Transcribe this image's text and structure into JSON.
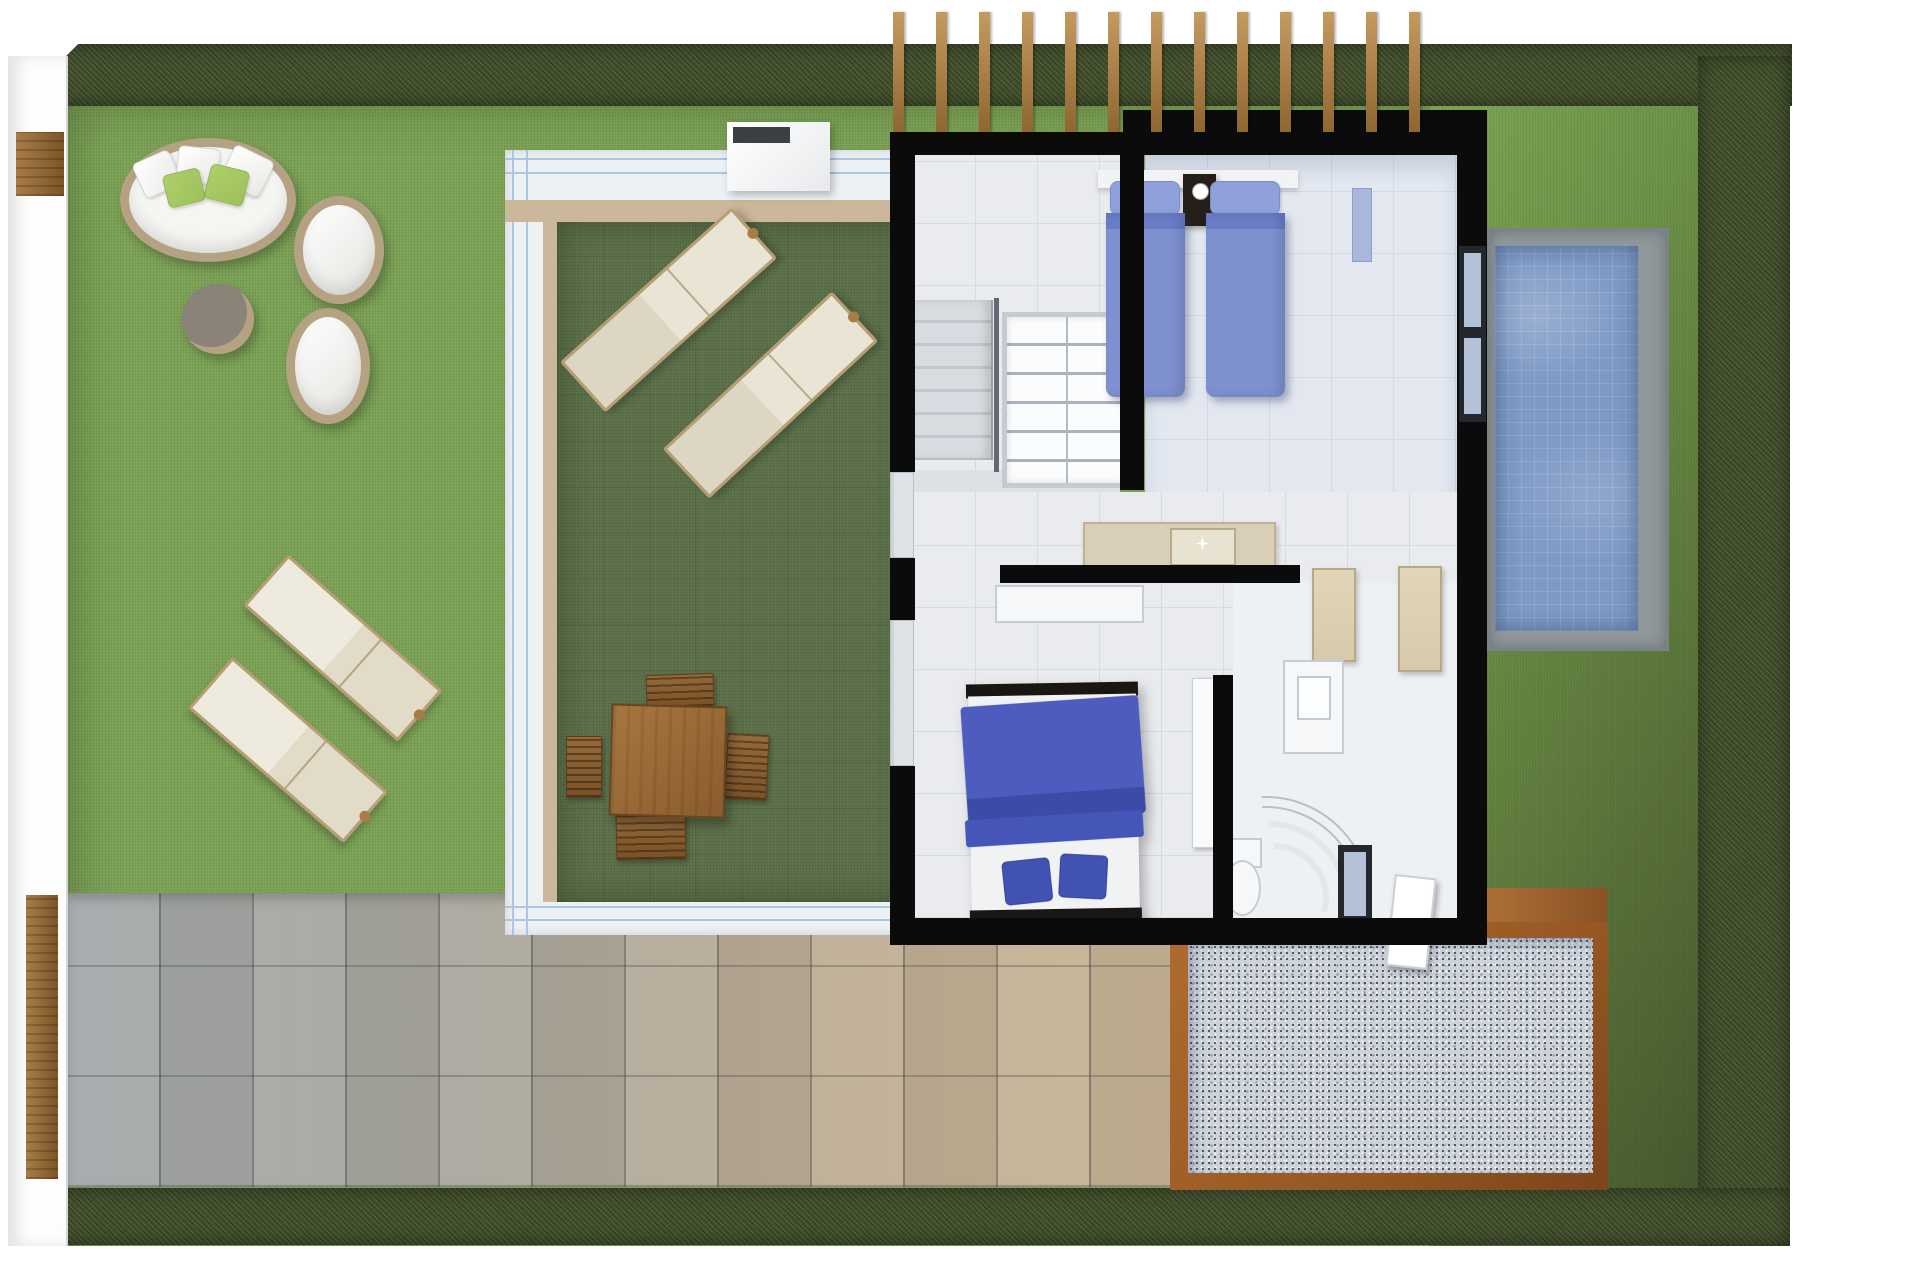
{
  "meta": {
    "title": "Villa upper-floor plan — 3D top-down render",
    "type": "architectural-render",
    "text_on_image": ""
  },
  "palette": {
    "white": "#ffffff",
    "hedge": "#46552f",
    "lawn": "#7ba155",
    "roof_lawn": "#5f744d",
    "walkway": "#eef1f4",
    "glass": "#a9c6e2",
    "tan": "#cbb79c",
    "wall": "#0b0b0c",
    "floor": "#e9ebef",
    "floor_twin": "#e2e7f0",
    "tile_line": "#d6dae1",
    "pool_deck": "#90979b",
    "pool_water": "#7d99c5",
    "patio_gray": "#a3a8ab",
    "patio_tan": "#c8b496",
    "gravel": "#ced3d9",
    "rust": "#9a5a25",
    "rust_light": "#b06c2f",
    "wood": "#a87c48",
    "wood_dark": "#7c5527",
    "wicker": "#b4a283",
    "green_pillow": "#9dc05c",
    "bed_blue": "#7e90d0",
    "bed_blue_fold": "#697cc6",
    "pillow_blue": "#8fa0da",
    "master_blue": "#4d5cbe",
    "master_cushion": "#4252b2",
    "night": "#261f19",
    "counter": "#d9ceb8",
    "counter_edge": "#c0b193",
    "cabinet": "#d7caac",
    "frame_dark": "#24272b",
    "glass_win": "#b3c2d6"
  },
  "areas": {
    "garden": {
      "label": "Garden lawn",
      "items": [
        "round daybed",
        "egg chair",
        "egg chair",
        "ottoman table",
        "sun lounger",
        "sun lounger"
      ]
    },
    "roof_garden": {
      "label": "Glass-railed roof terrace",
      "items": [
        "sun lounger",
        "sun lounger",
        "dining table",
        "4 wicker chairs",
        "skylight box"
      ]
    },
    "stair_hall": {
      "label": "Stair hall",
      "items": [
        "staircase",
        "railing",
        "bookshelf"
      ]
    },
    "twin_bedroom": {
      "label": "Twin bedroom",
      "items": [
        "twin bed",
        "twin bed",
        "nightstand",
        "lamp",
        "towel shelf"
      ]
    },
    "living": {
      "label": "Living / kitchenette",
      "items": [
        "kitchen counter",
        "sink",
        "media console"
      ]
    },
    "master_bedroom": {
      "label": "Master bedroom",
      "items": [
        "double bed",
        "2 cushions"
      ]
    },
    "bathroom": {
      "label": "Bathroom",
      "items": [
        "vanity cabinet",
        "tall cabinet",
        "wall cabinet",
        "towel arch",
        "toilet",
        "window"
      ]
    },
    "pool": {
      "label": "Swimming pool",
      "items": [
        "tiled water",
        "concrete deck"
      ]
    },
    "patio": {
      "label": "Stone tile patio",
      "items": []
    },
    "gravel": {
      "label": "Gravel court with corten frame",
      "items": []
    },
    "pergola": {
      "label": "Pergola beams",
      "slat_count": 13
    },
    "boundary": {
      "label": "Hedge boundary",
      "items": [
        "white wall",
        "wood gate",
        "wood gate"
      ]
    }
  }
}
